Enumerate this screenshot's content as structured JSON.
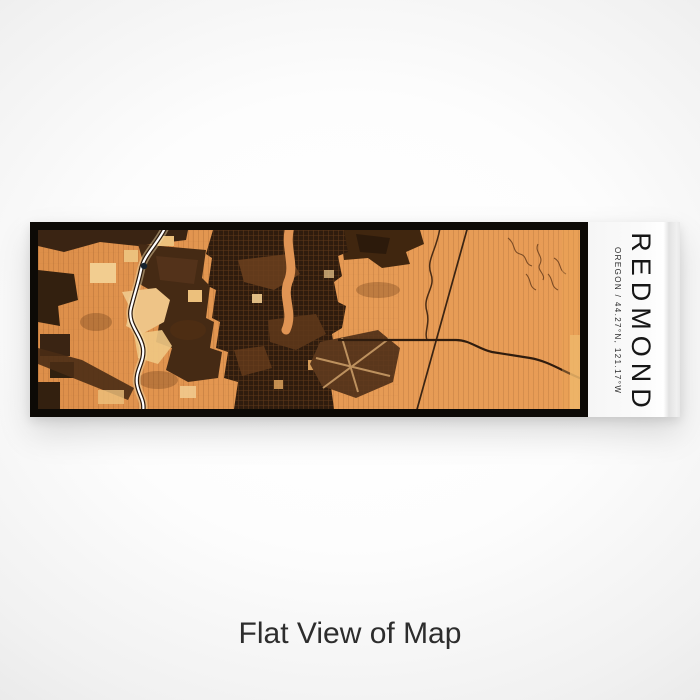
{
  "scene": {
    "caption": "Flat View of Map"
  },
  "print": {
    "title": "REDMOND",
    "subtitle": "OREGON / 44.27°N, 121.17°W",
    "city": "Redmond",
    "state": "Oregon",
    "coordinates": "44.27°N, 121.17°W",
    "view_style": "Flat"
  },
  "map": {
    "theme_colors": {
      "base_orange": "#e2944e",
      "dark_brown": "#3a2413",
      "deep_brown": "#2f1c0e",
      "mid_brown": "#6b3f1d",
      "cream": "#f2cd90",
      "river_white": "#ffffff",
      "frame_black": "#0d0a06",
      "label_white": "#f7f7f7"
    },
    "features": [
      "river",
      "urban-street-grid",
      "dry-canyon",
      "airport-runways",
      "diagonal-highway",
      "canyon-squiggles",
      "field-patches"
    ]
  }
}
